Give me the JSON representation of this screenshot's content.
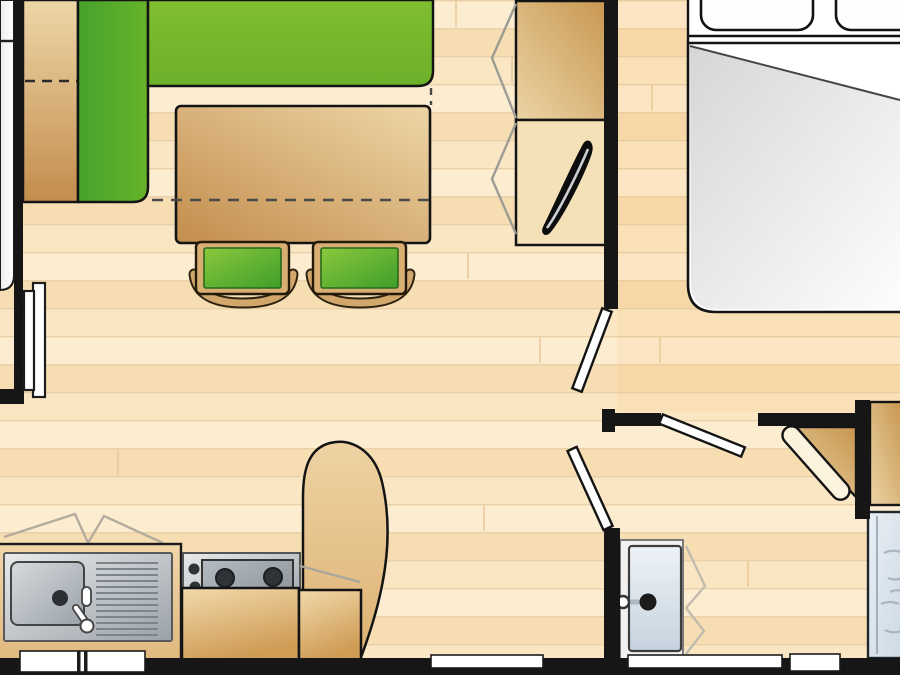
{
  "plan": {
    "kind": "floor-plan",
    "rooms": [
      "living-dining-area",
      "bedroom",
      "kitchen",
      "bathroom"
    ],
    "furniture": [
      "corner-sofa-bench",
      "sofa-backrest-cabinet",
      "dining-table",
      "stool-left",
      "stool-right",
      "tv-cabinet",
      "television",
      "bed",
      "pillow-left",
      "pillow-right",
      "duvet-fold",
      "kitchen-counter",
      "kitchen-sink",
      "drainboard",
      "stove",
      "kitchen-base-cabinet-left",
      "kitchen-base-cabinet-right",
      "peninsula-counter",
      "bathroom-vanity",
      "bathroom-sink",
      "corner-cabinet",
      "corner-cabinet-door",
      "wardrobe",
      "shower"
    ],
    "openings": [
      "entry-door",
      "bedroom-door-leaf",
      "bathroom-door-leaf",
      "corridor-door-leaf",
      "kitchen-window",
      "rear-window-left",
      "rear-window-right",
      "bathroom-window"
    ]
  },
  "colors": {
    "wall": "#161616",
    "floor_row1": "#fcecd0",
    "floor_row2": "#f7ddb2",
    "floor_row3": "#fae6c3",
    "floor_line": "#ead0a8",
    "sofa_green": "#76b82d",
    "sofa_green_dark": "#46a22c",
    "sofa_green_mid": "#67b32a",
    "stool_green_light": "#8ac83d",
    "stool_green_dark": "#3f9e2a",
    "wood_light": "#eed6a8",
    "wood_dark": "#c38d4c",
    "wood_frame": "#d8ae72",
    "steel_light": "#e9ebec",
    "steel_dark": "#9aa1a8",
    "burner": "#2e3338",
    "water_light": "#e9eff5",
    "water_dark": "#ccd9e4",
    "basin_light": "#eef3f7",
    "basin_dark": "#c6d3de",
    "fold_grey": "#d6d6d6",
    "door_white": "#ffffff",
    "chevron_grey": "#a8a399",
    "silver_edge": "#c9ced3"
  }
}
